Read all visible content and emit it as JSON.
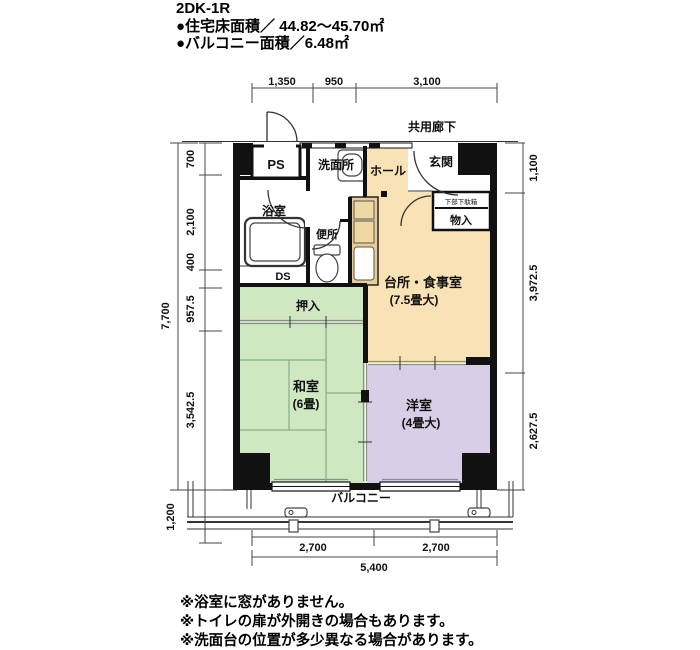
{
  "header": {
    "title": "2DK-1R",
    "area_line1": "●住宅床面積／ 44.82〜45.70㎡",
    "area_line2": "●バルコニー面積／6.48㎡"
  },
  "labels": {
    "corridor": "共用廊下",
    "ps": "PS",
    "entrance": "玄関",
    "hall": "ホール",
    "washroom": "洗面所",
    "bathroom": "浴室",
    "toilet": "便所",
    "ds": "DS",
    "shoebox_note": "下部下駄箱",
    "storage": "物入",
    "kitchen": "台所・食事室",
    "kitchen_size": "(7.5畳大)",
    "closet": "押入",
    "japanese_room": "和室",
    "japanese_room_size": "(6畳)",
    "western_room": "洋室",
    "western_room_size": "(4畳大)",
    "balcony": "バルコニー"
  },
  "dimensions": {
    "top": [
      "1,350",
      "950",
      "3,100"
    ],
    "left": [
      "700",
      "2,100",
      "400",
      "957.5",
      "3,542.5"
    ],
    "left_total": "7,700",
    "balcony_depth": "1,200",
    "right": [
      "1,100",
      "3,972.5",
      "2,627.5"
    ],
    "bottom": [
      "2,700",
      "2,700"
    ],
    "bottom_total": "5,400"
  },
  "notes": {
    "line1": "※浴室に窓がありません。",
    "line2": "※トイレの扉が外開きの場合もあります。",
    "line3": "※洗面台の位置が多少異なる場合があります。"
  },
  "colors": {
    "dining_kitchen": "#F8E2B6",
    "tatami_room": "#CFE8C2",
    "western_room": "#D9CEE7",
    "kitchen_counter": "#EACD96",
    "wall": "#111111"
  }
}
